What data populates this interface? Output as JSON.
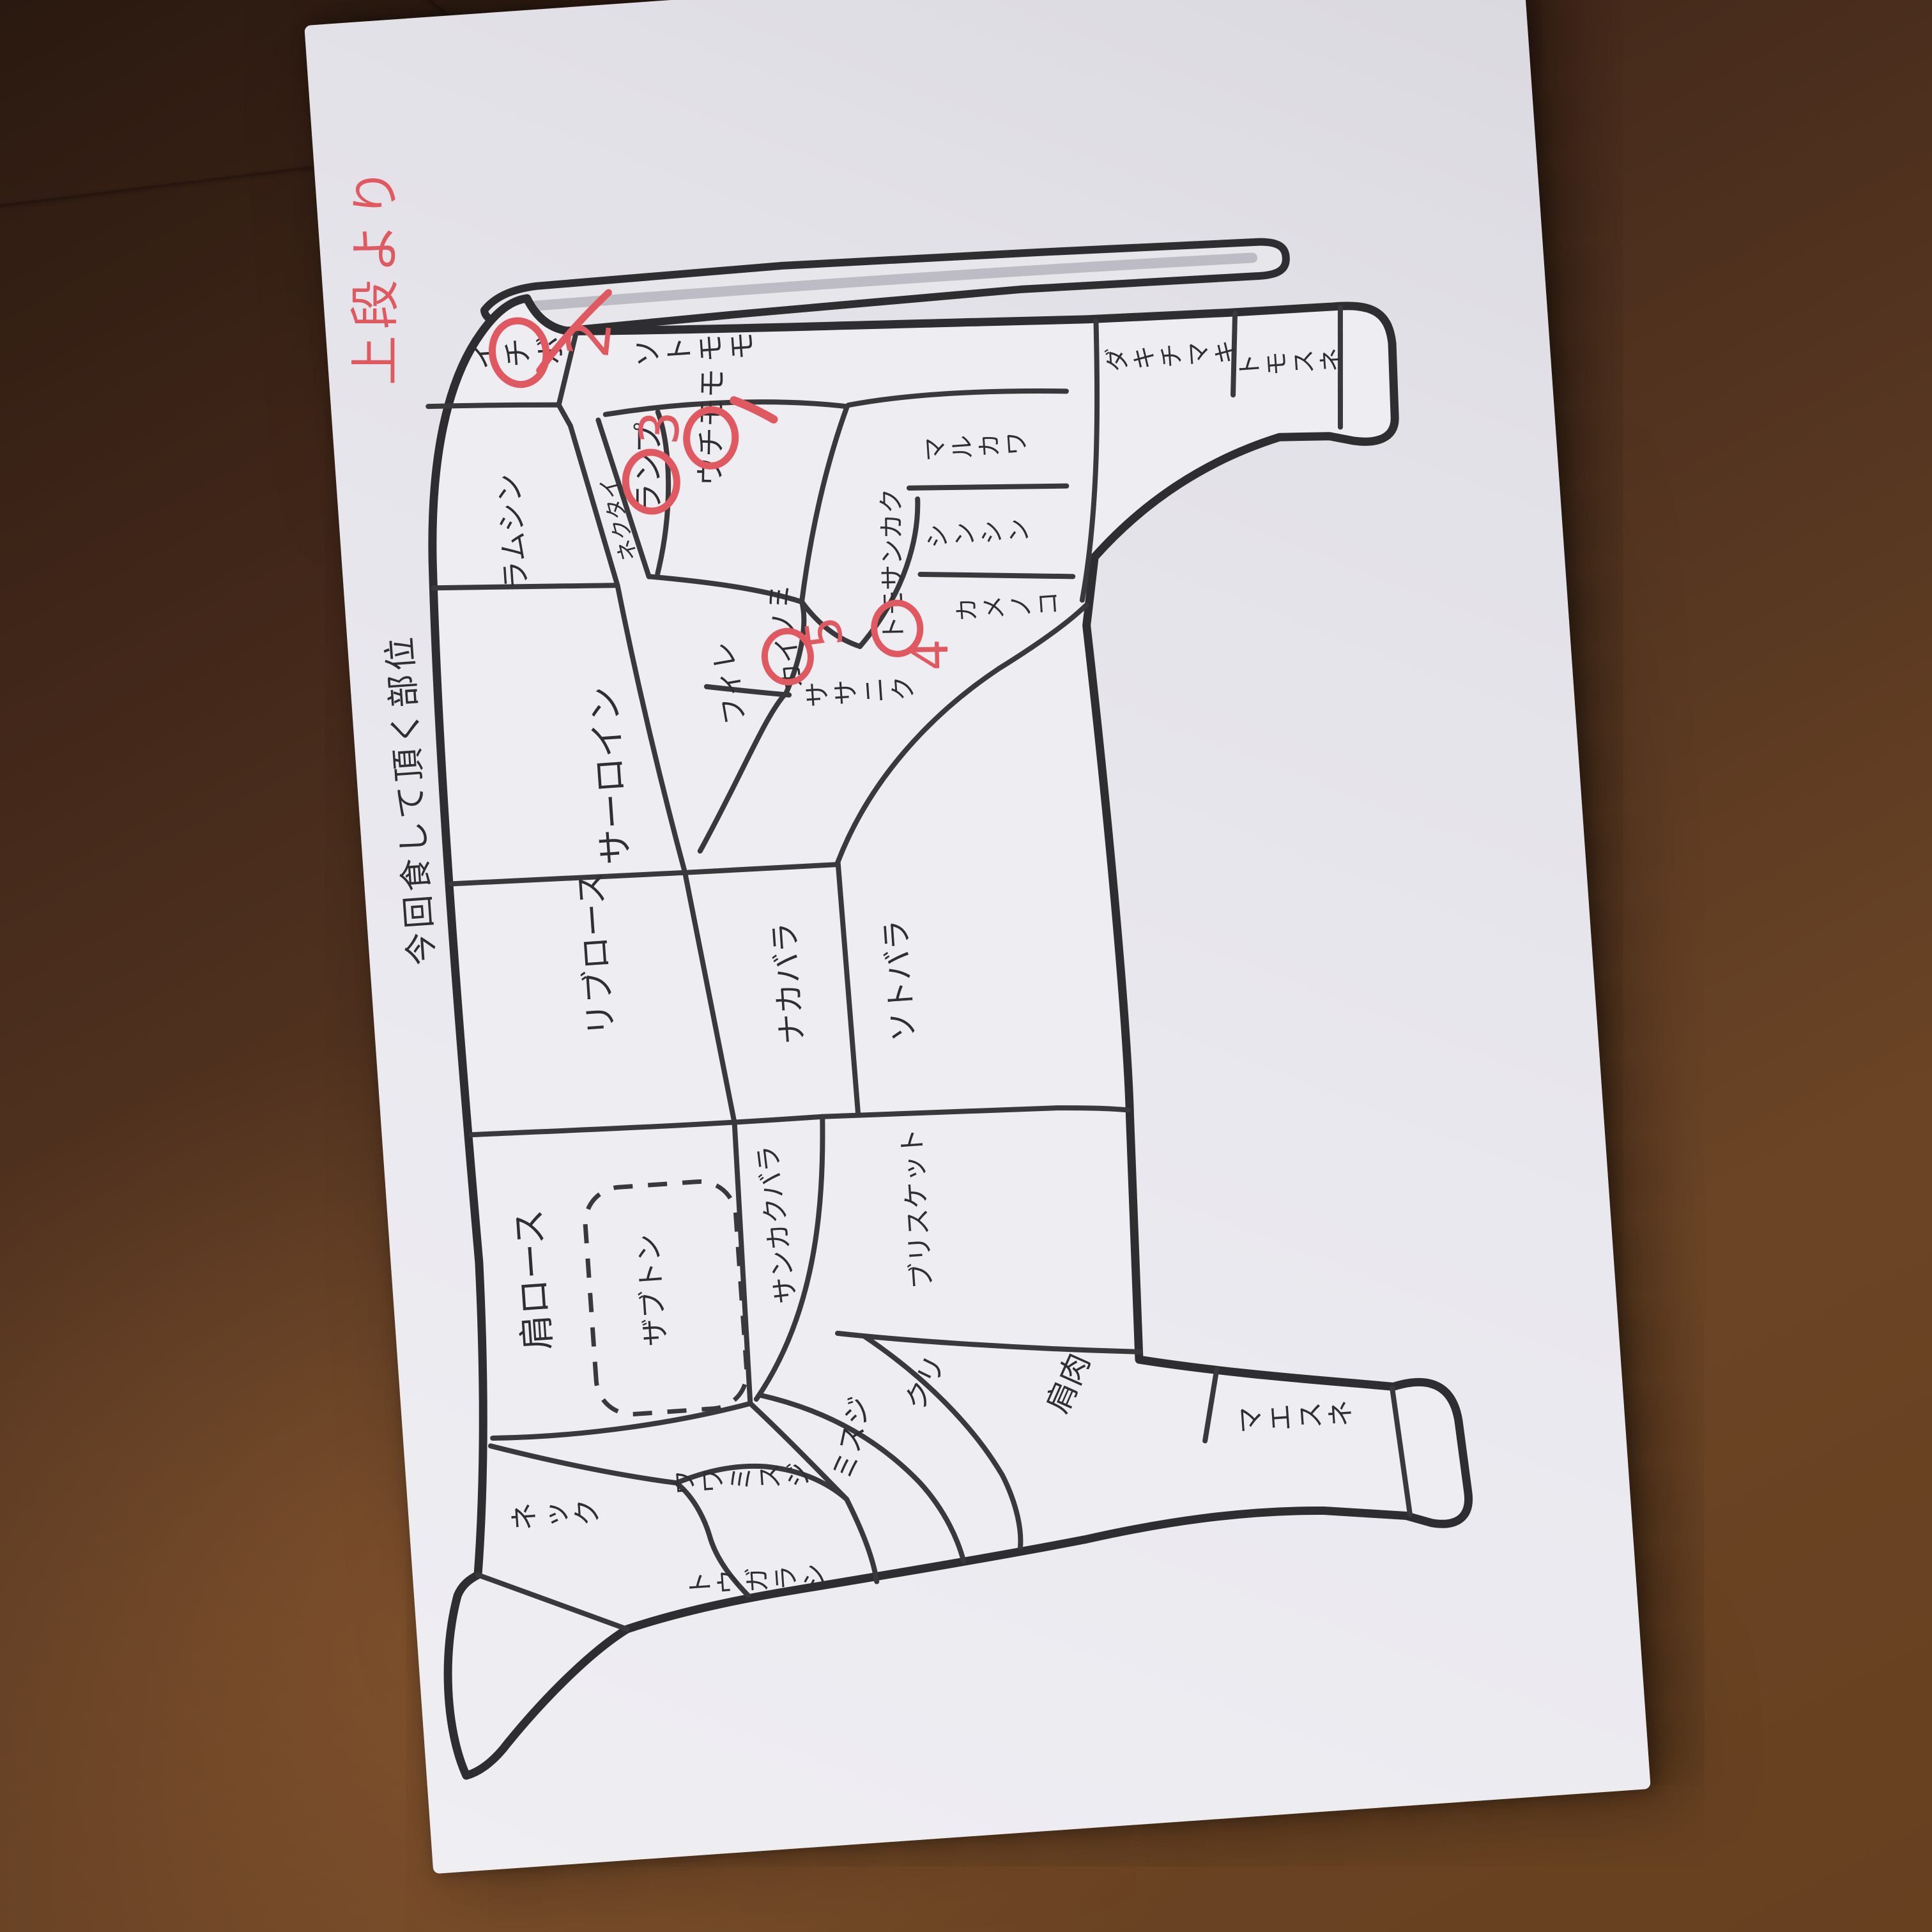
{
  "scene": {
    "surface": "brown-leather-table",
    "paper_color": "#e9e8ee",
    "ink_color": "#2f2e30",
    "marker_color": "#e05860"
  },
  "card": {
    "title": "今回食して頂く部位",
    "handwritten_note": "上段より",
    "cuts": {
      "neck": "ネック",
      "tougarashi": "トウガラシ",
      "uwamisuji": "ウワミスジ",
      "misuji": "ミスジ",
      "kuri": "クリ",
      "kataniku": "肩肉",
      "maesune": "マエスネ",
      "katarosu": "肩ロース",
      "zabuton": "ザブトン",
      "sankakubara": "サンカクバラ",
      "brisket": "ブリスケット",
      "riburosu": "リブロース",
      "nakabara": "ナカバラ",
      "sotobara": "ソトバラ",
      "sirloin": "サーロイン",
      "fillet": "フィレ",
      "kainomi": "カイノミ",
      "sasaniku": "ササニク",
      "necktie": "ネクタイ",
      "ramushin": "ラムシン",
      "rump": "ランプ",
      "ichibo": "イチボ",
      "sotomomo": "ソトモモ",
      "uchimomo": "ウチモモ",
      "marukawa": "マルカワ",
      "shinshin": "シンシン",
      "kamenoko": "カメノコ",
      "tomosankaku": "トモサンカク",
      "dakichimaki": "ダキチマキ",
      "tomosune": "トモスネ"
    },
    "marks": {
      "uchimomo": "1",
      "ichibo": "2",
      "rump": "3",
      "tomosankaku": "4",
      "kainomi": "5"
    }
  }
}
